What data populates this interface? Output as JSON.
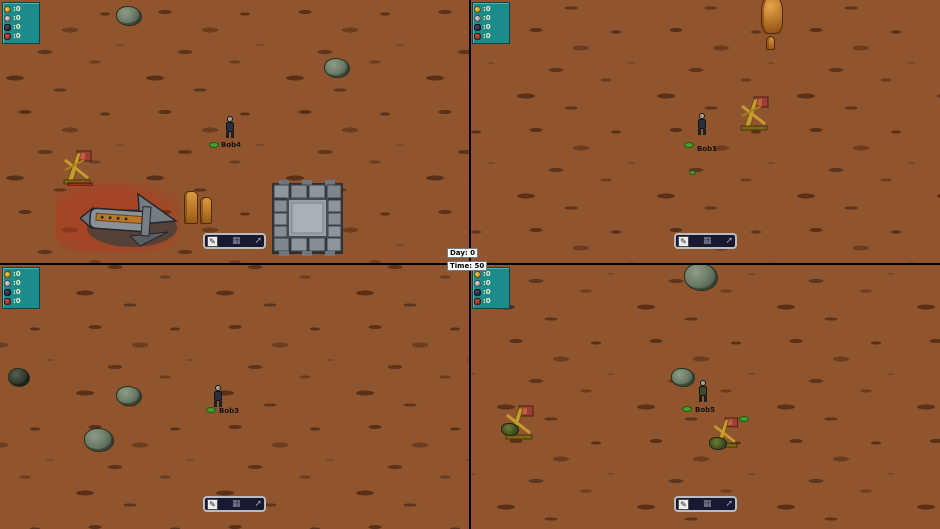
{
  "overlay": {
    "day": "Day: 0",
    "time": "Time: 50"
  },
  "hud": {
    "resources": [
      {
        "icon": "gold-resource-icon",
        "color": "#d8a01c",
        "value": ":0"
      },
      {
        "icon": "silver-resource-icon",
        "color": "#aab0b4",
        "value": ":0"
      },
      {
        "icon": "ore-resource-icon",
        "color": "#262a34",
        "value": ":0"
      },
      {
        "icon": "meat-resource-icon",
        "color": "#9e3226",
        "value": ":0"
      }
    ],
    "toolbar": {
      "edit": "✎",
      "grid": "▦",
      "arrow": "➚"
    }
  },
  "players": [
    {
      "name": "Bob4"
    },
    {
      "name": "Bob1"
    },
    {
      "name": "Bob3"
    },
    {
      "name": "Bob5"
    }
  ],
  "colors": {
    "terrain": "#90552f",
    "panel": "#1b8b8d",
    "alert_zone": "#c82812"
  }
}
